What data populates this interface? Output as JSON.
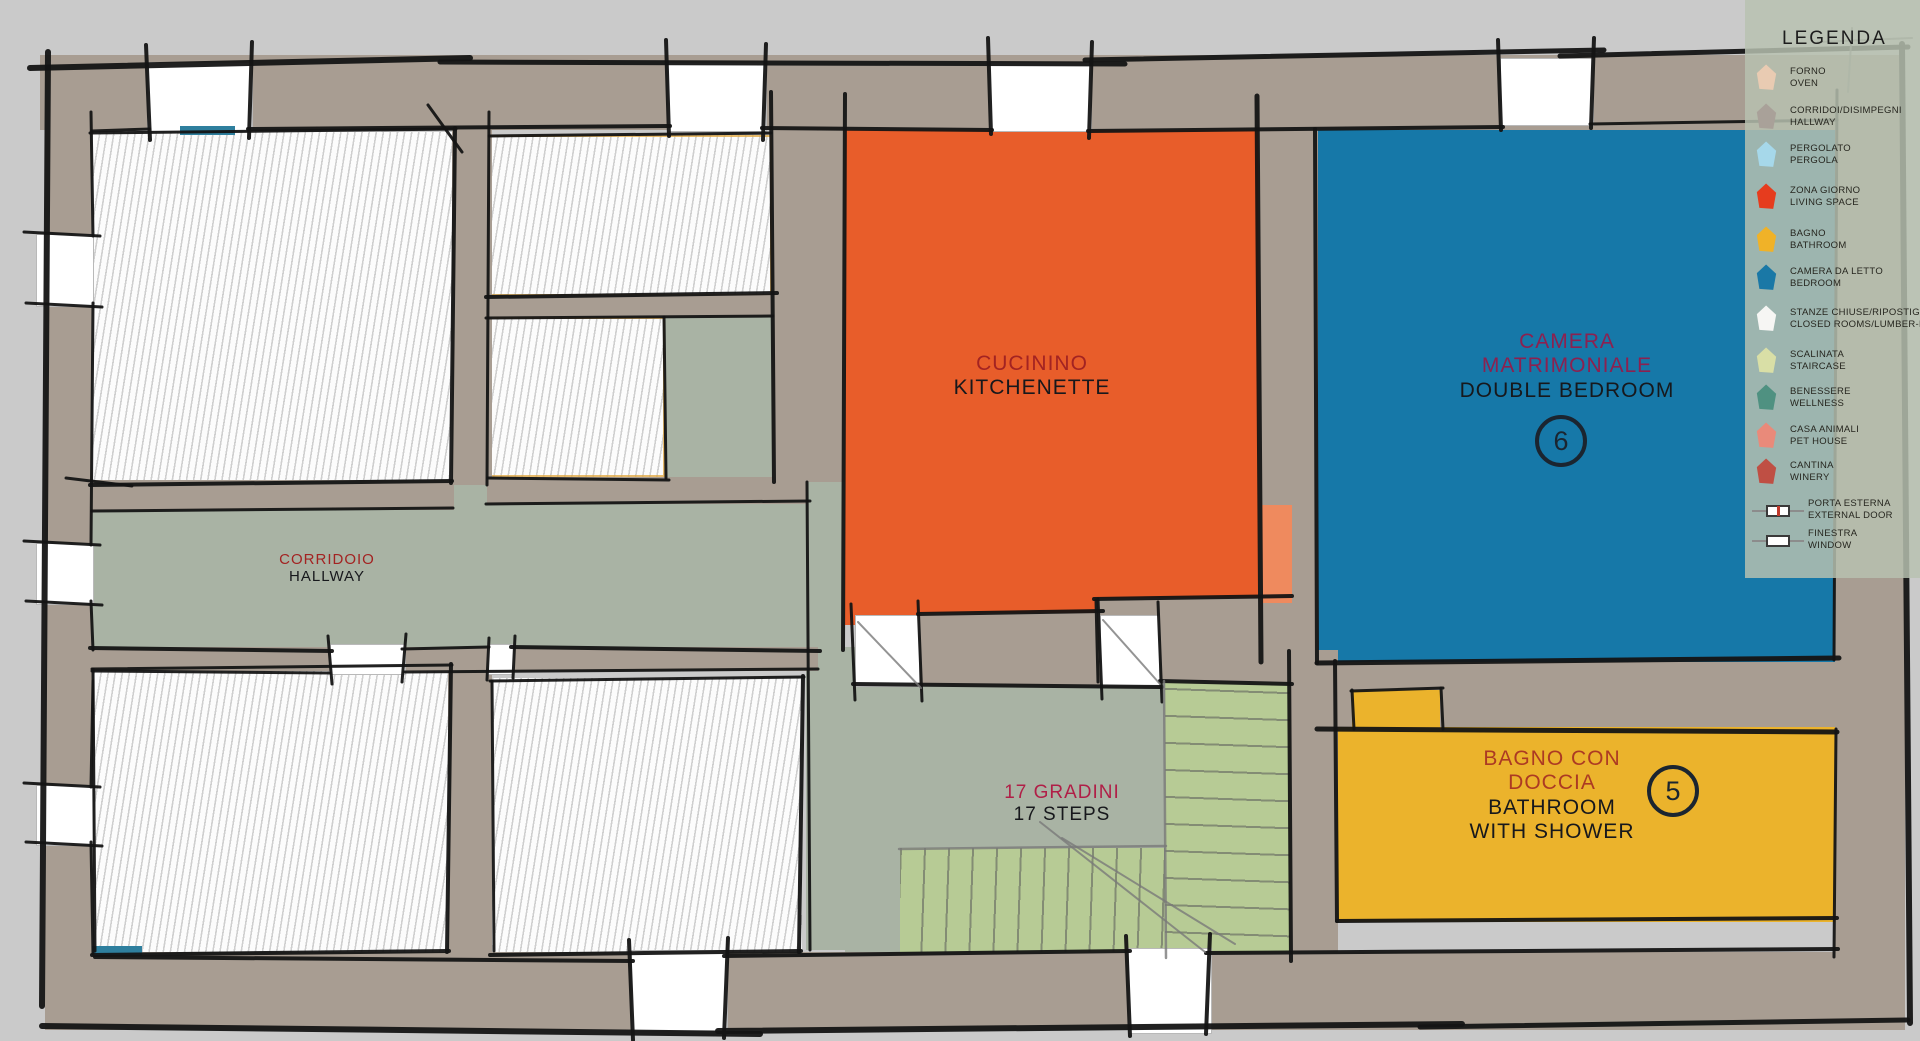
{
  "legend": {
    "title": "LEGENDA",
    "items": [
      {
        "id": "forno",
        "it": "FORNO",
        "en": "OVEN",
        "color": "#e9cbb2",
        "type": "pentagon"
      },
      {
        "id": "corridoi",
        "it": "CORRIDOI/DISIMPEGNI",
        "en": "HALLWAY",
        "color": "#a9a199",
        "type": "pentagon"
      },
      {
        "id": "pergolato",
        "it": "PERGOLATO",
        "en": "PERGOLA",
        "color": "#a6d8ea",
        "type": "pentagon"
      },
      {
        "id": "zona-giorno",
        "it": "ZONA GIORNO",
        "en": "LIVING SPACE",
        "color": "#e63c1e",
        "type": "pentagon"
      },
      {
        "id": "bagno",
        "it": "BAGNO",
        "en": "BATHROOM",
        "color": "#f0b228",
        "type": "pentagon"
      },
      {
        "id": "camera-da-letto",
        "it": "CAMERA DA LETTO",
        "en": "BEDROOM",
        "color": "#1a78a6",
        "type": "pentagon"
      },
      {
        "id": "stanze-chiuse",
        "it": "STANZE CHIUSE/RIPOSTIGLIO",
        "en": "CLOSED ROOMS/LUMBER-ROOM",
        "color": "#f6f6f4",
        "type": "pentagon"
      },
      {
        "id": "scalinata",
        "it": "SCALINATA",
        "en": "STAIRCASE",
        "color": "#d9dfa6",
        "type": "pentagon"
      },
      {
        "id": "benessere",
        "it": "BENESSERE",
        "en": "WELLNESS",
        "color": "#4f9181",
        "type": "pentagon"
      },
      {
        "id": "casa-animali",
        "it": "CASA ANIMALI",
        "en": "PET HOUSE",
        "color": "#e98a7a",
        "type": "pentagon"
      },
      {
        "id": "cantina",
        "it": "CANTINA",
        "en": "WINERY",
        "color": "#bf4f44",
        "type": "pentagon"
      },
      {
        "id": "porta-esterna",
        "it": "PORTA ESTERNA",
        "en": "EXTERNAL DOOR",
        "type": "door"
      },
      {
        "id": "finestra",
        "it": "FINESTRA",
        "en": "WINDOW",
        "type": "window"
      }
    ]
  },
  "rooms": {
    "kitchenette": {
      "it": "CUCININO",
      "en": "KITCHENETTE"
    },
    "bedroom": {
      "it_line1": "CAMERA",
      "it_line2": "MATRIMONIALE",
      "en": "DOUBLE BEDROOM",
      "number": "6"
    },
    "bathroom": {
      "it_line1": "BAGNO CON",
      "it_line2": "DOCCIA",
      "en_line1": "BATHROOM",
      "en_line2": "WITH SHOWER",
      "number": "5"
    },
    "hallway": {
      "it": "CORRIDOIO",
      "en": "HALLWAY"
    },
    "staircase": {
      "it": "17 GRADINI",
      "en": "17 STEPS"
    }
  },
  "colors": {
    "background": "#cacaca",
    "wall": "#a89d92",
    "hallway": "#a9b3a4",
    "kitchenette": "#e85d2a",
    "bedroom": "#1678a8",
    "bathroom": "#ebb32c",
    "staircase": "#b7cb95",
    "legend_panel": "#b7c1b0",
    "accent_window": "#2e7f9e",
    "door_marker": "#ef8a5e",
    "label_red": "#a32322",
    "label_magenta": "#8c2150",
    "label_brick": "#ac3a23",
    "label_crimson": "#b01f47",
    "label_dark": "#17181c"
  }
}
